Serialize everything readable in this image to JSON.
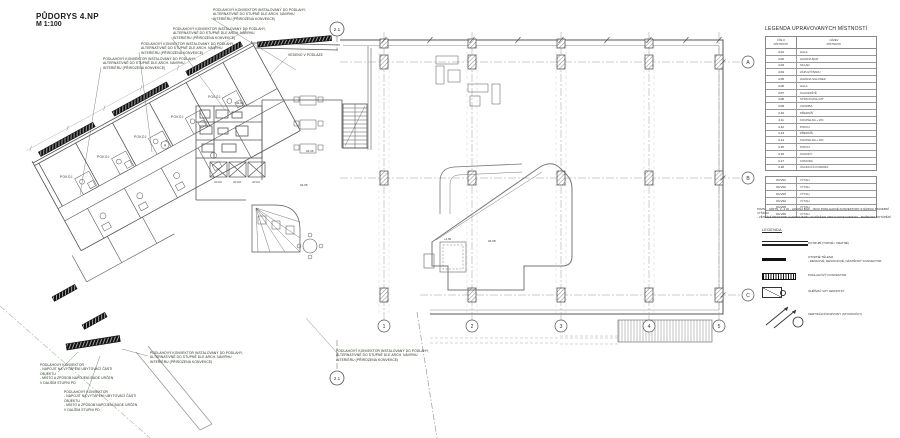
{
  "title": {
    "line1": "PŮDORYS 4.NP",
    "line2": "M 1:100"
  },
  "colors": {
    "ink": "#333333",
    "convector": "#111111",
    "grid": "#8a8a8a",
    "background": "#ffffff"
  },
  "legend_table": {
    "title": "LEGENDA UPRAVOVANÝCH MÍSTNOSTÍ",
    "col1": "ČÍSLO\nMÍSTNOSTI",
    "col2": "NÁZEV\nMÍSTNOSTI",
    "rooms": [
      {
        "num": "4.01",
        "name": "HALA"
      },
      {
        "num": "4.02",
        "name": "HAVANA BAR"
      },
      {
        "num": "4.03",
        "name": "SKLAD"
      },
      {
        "num": "4.04",
        "name": "ZÁPULTÍ BARU"
      },
      {
        "num": "4.05",
        "name": "HAVANA SALONEK"
      },
      {
        "num": "4.06",
        "name": "HALA"
      },
      {
        "num": "4.07",
        "name": "SCHODIŠTĚ"
      },
      {
        "num": "4.08",
        "name": "STROJOVNA VZT"
      },
      {
        "num": "4.09",
        "name": "CHODBA"
      },
      {
        "num": "4.10",
        "name": "PŘEDSÍŇ"
      },
      {
        "num": "4.11",
        "name": "KOUPELNA + WC"
      },
      {
        "num": "4.12",
        "name": "POKOJ"
      },
      {
        "num": "4.13",
        "name": "PŘEDSÍŇ"
      },
      {
        "num": "4.14",
        "name": "KOUPELNA + WC"
      },
      {
        "num": "4.15",
        "name": "POKOJ"
      },
      {
        "num": "4.16",
        "name": "SCHODY"
      },
      {
        "num": "4.17",
        "name": "KOMORA"
      },
      {
        "num": "4.18",
        "name": "ÚKLIDOVÁ KOMORA"
      }
    ],
    "elevators": [
      {
        "num": "04.V01",
        "name": "VÝTAH"
      },
      {
        "num": "04.V02",
        "name": "VÝTAH"
      },
      {
        "num": "04.V03",
        "name": "VÝTAH"
      },
      {
        "num": "04.V04",
        "name": "VÝTAH"
      },
      {
        "num": "04.V05",
        "name": "VÝTAH"
      },
      {
        "num": "04.V06",
        "name": "VÝTAH"
      }
    ]
  },
  "note": {
    "text": "POZN.:  - MÍSTN. Č. 4.02 - HAVANA BAR - JSOU PODLAHOVÉ KONVEKTORY S NÍZKOU STAVEBNÍ VÝŠKOU\n- VĚTRÁNÍ PROSTORU HAVANA BARU ZAJIŠTĚNO VZDUCHOTECHNIKOU - MOŽNOST DOTÁPĚNÍ"
  },
  "symbol_legend": {
    "title": "LEGENDA",
    "items": [
      {
        "symbol": "pipes-icon",
        "label": "POTRUBÍ (TOPNÉ / VRATNÉ)"
      },
      {
        "symbol": "radiator-icon",
        "label": "OTOPNÉ TĚLESO\n- DESKOVÉ, DESIGNOVÉ, NÁSTĚNNÝ KONVEKTOR"
      },
      {
        "symbol": "floor-convector-icon",
        "label": "PODLAHOVÝ KONVEKTOR"
      },
      {
        "symbol": "vzt-heater-icon",
        "label": "OHŘÍVAČ VZT JEDNOTKY"
      },
      {
        "symbol": "risers-icon",
        "label": "VERTIKÁLNÍ ROZVODY (STOUPAČKY)"
      }
    ]
  },
  "callouts": [
    {
      "x": 213,
      "y": 8,
      "w": 112,
      "text": "PODLAHOVÝ KONVEKTOR INSTALOVANÝ DO PODLAHY,\nALTERNATIVNĚ DO STUPNĚ DLE ARCH. NÁVRHU\nINTERIÉRU (PŘIROZENÁ KONVEKCE)"
    },
    {
      "x": 173,
      "y": 27,
      "w": 108,
      "text": "PODLAHOVÝ KONVEKTOR INSTALOVANÝ DO PODLAHY,\nALTERNATIVNĚ DO STUPNĚ DLE ARCH. NÁVRHU\nINTERIÉRU (PŘIROZENÁ KONVEKCE)"
    },
    {
      "x": 141,
      "y": 42,
      "w": 108,
      "text": "PODLAHOVÝ KONVEKTOR INSTALOVANÝ DO PODLAHY,\nALTERNATIVNĚ DO STUPNĚ DLE ARCH. NÁVRHU\nINTERIÉRU (PŘIROZENÁ KONVEKCE)"
    },
    {
      "x": 103,
      "y": 57,
      "w": 108,
      "text": "PODLAHOVÝ KONVEKTOR INSTALOVANÝ DO PODLAHY,\nALTERNATIVNĚ DO STUPNĚ DLE ARCH. NÁVRHU\nINTERIÉRU (PŘIROZENÁ KONVEKCE)"
    },
    {
      "x": 288,
      "y": 53,
      "w": 60,
      "text": "VEDENO V PODLAZE"
    },
    {
      "x": 336,
      "y": 349,
      "w": 110,
      "text": "PODLAHOVÝ KONVEKTOR INSTALOVANÝ DO PODLAHY,\nALTERNATIVNĚ DO STUPNĚ DLE ARCH. NÁVRHU\nINTERIÉRU (PŘIROZENÁ KONVEKCE)"
    },
    {
      "x": 150,
      "y": 351,
      "w": 108,
      "text": "PODLAHOVÝ KONVEKTOR INSTALOVANÝ DO PODLAHY,\nALTERNATIVNĚ DO STUPNĚ DLE ARCH. NÁVRHU\nINTERIÉRU (PŘIROZENÁ KONVEKCE)"
    },
    {
      "x": 40,
      "y": 363,
      "w": 92,
      "text": "PODLAHOVÝ KONVEKTOR\n- NAPOJIT NA VYTÁPĚNÍ UBYTOVACÍ ČÁSTI\n  OBJEKTU\n- MÍSTO A ZPŮSOB NAPOJENÍ BUDE URČEN\n  V DALŠÍM STUPNI PD"
    },
    {
      "x": 64,
      "y": 390,
      "w": 92,
      "text": "PODLAHOVÝ KONVEKTOR\n- NAPOJIT NA VYTÁPĚNÍ UBYTOVACÍ ČÁSTI\n  OBJEKTU\n- MÍSTO A ZPŮSOB NAPOJENÍ BUDE URČEN\n  V DALŠÍM STUPNI PD"
    }
  ],
  "plan": {
    "grid": {
      "cols": [
        "1",
        "2",
        "3",
        "4",
        "5"
      ],
      "rows": [
        "A",
        "B",
        "C"
      ]
    },
    "section_marker": "2.1",
    "labels": {
      "pokoj": "POKOJ",
      "room_0402": "04.02",
      "room_0405": "04.05",
      "room_0406": "04.06",
      "room_0408": "04.08",
      "elev_405": "+4,05",
      "lift1": "04.V02",
      "lift2": "04.V03",
      "lift3": "04.V01",
      "marker_a": "A"
    }
  }
}
